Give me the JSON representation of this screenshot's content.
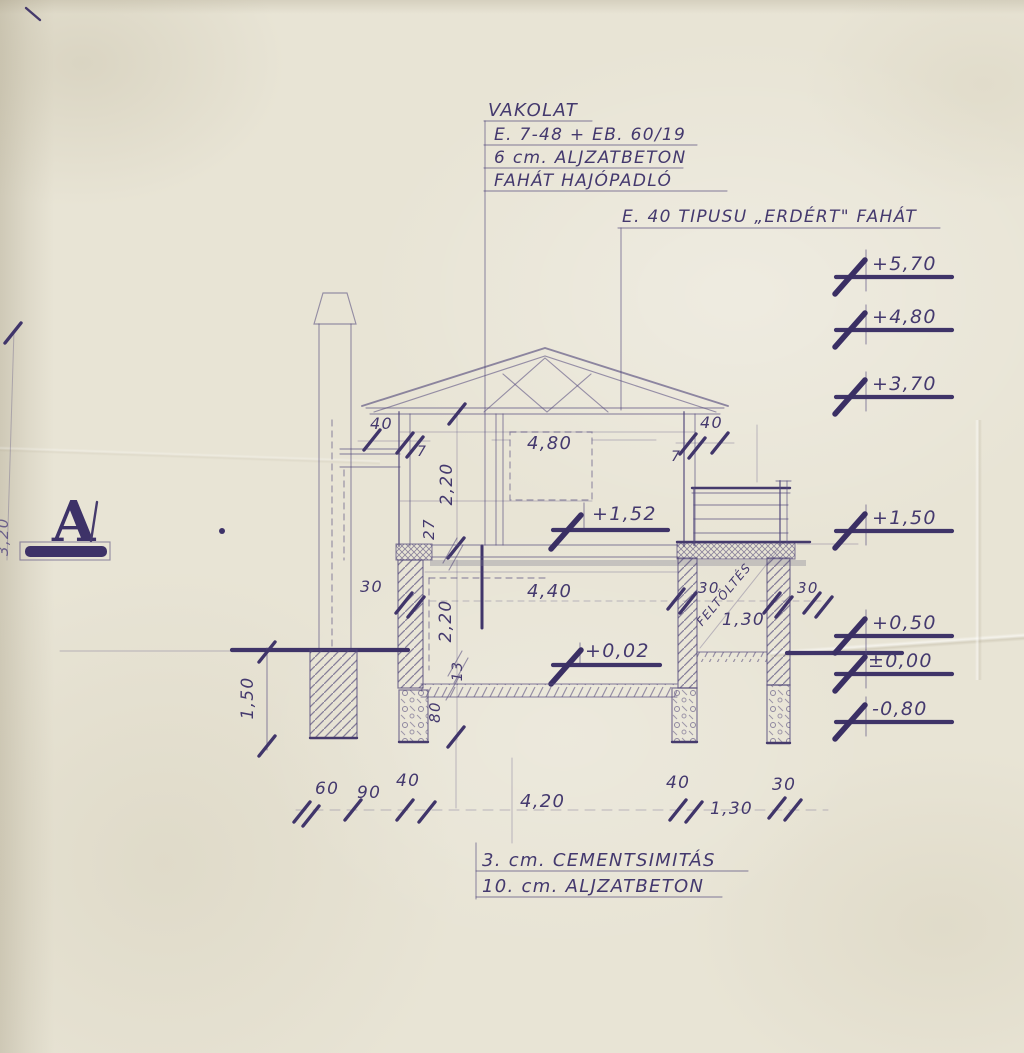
{
  "colors": {
    "paper": "#e8e4d5",
    "ink": "#3f3468",
    "pencil": "#5a4e82"
  },
  "section_label": "A",
  "notes_top": [
    "VAKOLAT",
    "E. 7-48 + EB. 60/19",
    "6 cm. ALJZATBETON",
    "FAHÁT HAJÓPADLÓ"
  ],
  "note_right": "E. 40 TIPUSU „ERDÉRT\" FAHÁT",
  "notes_bottom": [
    "3. cm. CEMENTSIMITÁS",
    "10. cm. ALJZATBETON"
  ],
  "elevation_marks": [
    "+5,70",
    "+4,80",
    "+3,70",
    "+1,50",
    "+0,50",
    "±0,00",
    "-0,80"
  ],
  "level_marks": {
    "upper_floor": "+1,52",
    "ground_floor": "+0,02"
  },
  "dimensions": {
    "eave_left": "40",
    "eave_left_offset": "7",
    "eave_right": "40",
    "eave_right_offset": "7",
    "upper_room_width": "4,80",
    "upper_room_height": "2,20",
    "mid_slab": "27",
    "left_wall": "30",
    "room_width": "4,40",
    "room_height": "2,20",
    "floor_layer": "13",
    "foundation_depth": "80",
    "terrace_wall_inner": "30",
    "terrace_wall_outer": "30",
    "terrace_width": "1,30",
    "chimney_foundation": "1,50",
    "fill_label": "FELTÖLTÉS",
    "edge": "3,20",
    "bottom_row": [
      "60",
      "90",
      "40",
      "4,20",
      "40",
      "1,30",
      "30"
    ]
  }
}
